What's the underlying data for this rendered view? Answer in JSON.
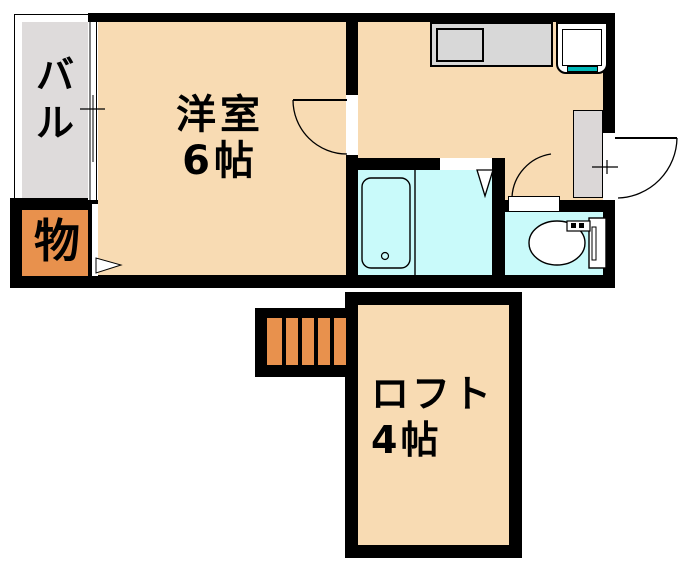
{
  "canvas": {
    "width": 684,
    "height": 573,
    "background": "#FFFFFF"
  },
  "colors": {
    "wall": "#000000",
    "room_fill": "#F8DBB3",
    "balcony_fill": "#DEDBDB",
    "storage_fill": "#E8914D",
    "stairs_fill": "#E8914D",
    "wet_area_fill": "#C9FAFA",
    "counter_fill": "#D8D8D8",
    "entry_mat_fill": "#DBD7D7",
    "sink_accent": "#00B8B8"
  },
  "rooms": {
    "western_room": {
      "line1": "洋室",
      "line2": "6帖"
    },
    "balcony": {
      "name": "バル",
      "char_top": "バ",
      "char_bottom": "ル"
    },
    "storage": {
      "name": "物"
    },
    "loft": {
      "line1": "ロフト",
      "line2": "4帖"
    }
  },
  "fixtures": [
    "kitchen-counter",
    "kitchen-sink",
    "bathtub",
    "bath-drain",
    "toilet",
    "entrance-door",
    "room-door",
    "toilet-door",
    "bathroom-folding-door",
    "balcony-window",
    "staircase",
    "closet-arrow",
    "entry-mat"
  ]
}
